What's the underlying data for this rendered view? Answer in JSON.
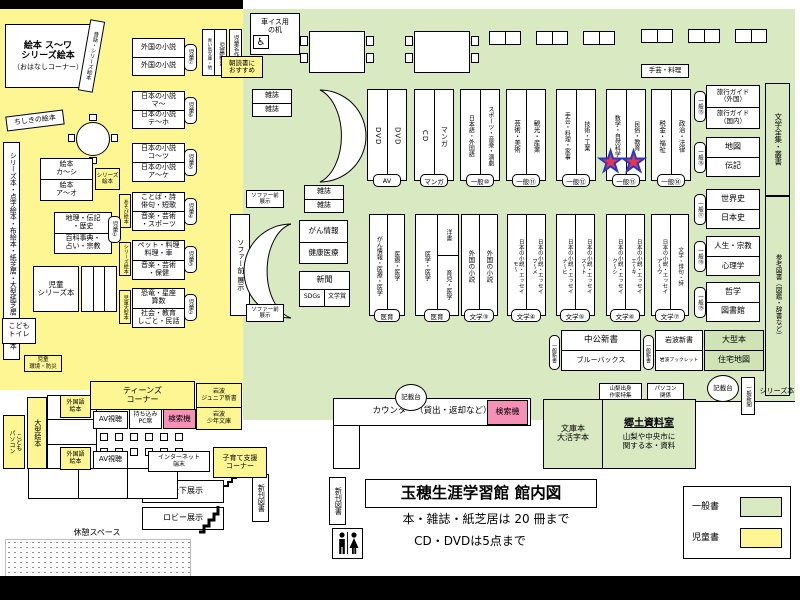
{
  "colors": {
    "general_zone": "#d9eac3",
    "children_zone": "#fdf693",
    "search_machine_pink": "#f590b6",
    "star_fill": "#e8344e",
    "star_border": "#2439c8"
  },
  "title_block": {
    "title": "玉穂生涯学習館 館内図",
    "rule1": "本・雑誌・紙芝居は 20 冊まで",
    "rule2": "CD・DVDは5点まで"
  },
  "legend": {
    "general": "一般書",
    "children": "児童書"
  },
  "kids": {
    "ohanashi1": "絵本 ス～ワ",
    "ohanashi2": "シリーズ絵本",
    "ohanashi3": "（おはなしコーナー）",
    "mukashi_shelf": "昔話・シリーズ絵本",
    "chishiki": "ちしきの絵本",
    "left_strip": "シリーズ本・点字絵本・布絵本・紙芝居・大型紙芝居・大型絵本",
    "shelf7": {
      "top": "外国の小説",
      "bottom": "外国の小説",
      "tag": "児童⑦"
    },
    "shelf6": {
      "top": "日本の小説\nマ～",
      "bottom": "日本の小説\nテ～ホ",
      "tag": "児童⑥"
    },
    "shelf5": {
      "top": "日本の小説\nコ～ツ",
      "bottom": "日本の小説\nア～ケ",
      "tag": "児童⑤"
    },
    "shelf4": {
      "top": "ことば・詩\n俳句・短歌",
      "bottom": "音楽・芸術\n・スポーツ",
      "tag": "児童④",
      "side": "あそび絵本"
    },
    "shelf3": {
      "top": "ペット・料理\n料理・車",
      "bottom": "音楽・芸術\n・保健",
      "tag": "児童③",
      "side": "シリーズ絵本"
    },
    "shelf2": {
      "top": "恐竜・星座\n算数",
      "bottom": "社会・教育\nしごと・民話",
      "tag": "児童②",
      "side": "児童大型本"
    },
    "ehon_ka": {
      "top": "絵本\nカ～シ",
      "bottom": "絵本\nア～オ",
      "side": "シリーズ\n絵本"
    },
    "shelf1": {
      "top": "地理・伝記\n・歴史",
      "bottom": "百科事典・\n占い・宗教",
      "tag": "児童①"
    },
    "jido_series": "児童\nシリーズ本",
    "kodomo_toilet": "こども\nトイレ",
    "jido_kankyo": "児童\n環境・防災",
    "ogata_ehon": "大型絵本",
    "kodomo_pc": "こども\nパソコン",
    "jido_shinsho": "児童新書",
    "aoitori": "青い鳥文庫・他",
    "jido_meisaku": "児童名作",
    "asadoku": "朝読書に\nおすすめ"
  },
  "teens": {
    "corner": "ティーンズ\nコーナー",
    "av": "AV視聴",
    "pc_seat": "持ち込み\nPC席",
    "search": "検索機",
    "gaikokugo_ehon": "外国語\n絵本",
    "iwanami_jr": "岩波\nジュニア新書",
    "iwanami_shonen": "岩波\n少年文庫",
    "internet": "インターネット\n端末",
    "kosodate": "子育て支援\nコーナー"
  },
  "general": {
    "wheelchair_desk": "車イス用\nの机",
    "magazine": "雑誌",
    "sofa_front_v": "ソファー前 展示",
    "sofa_front": "ソファー前\n展示",
    "cancer_box": {
      "top": "がん情報",
      "bottom": "健康医療"
    },
    "news_box": {
      "top": "新聞",
      "left": "SDGs",
      "right": "文学賞"
    },
    "craft_note": "手芸・料理",
    "row1": [
      {
        "left": "DVD",
        "right": "DVD",
        "tag": "AV"
      },
      {
        "left": "CD",
        "right": "マンガ",
        "tag": "マンガ"
      },
      {
        "left": "日本語・外国語",
        "right": "スポーツ・音楽・演劇",
        "tag": "一般⑩"
      },
      {
        "left": "芸術・美術",
        "right": "観光・産業",
        "tag": "一般⑪"
      },
      {
        "left": "手芸・料理・家事",
        "right": "技術・工業",
        "tag": "一般⑫"
      },
      {
        "left": "数学・自然科学",
        "right": "民俗・教育",
        "tag": "一般⑬"
      },
      {
        "left": "税金・福祉",
        "right": "政治・法律",
        "tag": "一般⑭"
      }
    ],
    "row2": [
      {
        "left": "がん情報・医療・医学",
        "right": "医療・医学",
        "tag": "医育"
      },
      {
        "left": "医学・医学",
        "right_top": "洋書",
        "right_bottom": "育児・医学",
        "tag": "医育"
      },
      {
        "left": "外国の小説",
        "right": "外国の小説",
        "tag": "文学③"
      },
      {
        "left": "日本の小説・エッセイ\nモ～",
        "right": "日本の小説・エッセイ\nフ～メ",
        "tag": "文学④"
      },
      {
        "left": "日本の小説・エッセイ\nナ～ヒ",
        "right": "日本の小説・エッセイ\nス～ト",
        "tag": "文学⑤"
      },
      {
        "left": "日本の小説・エッセイ\nク～シ",
        "right": "日本の小説・エッセイ\nエ～キ",
        "tag": "文学⑥"
      },
      {
        "left": "日本の小説・エッセイ\nア～ウ",
        "right": "文学・俳句・詩",
        "tag": "文学⑦"
      }
    ],
    "right_col": [
      {
        "top": "旅行ガイド\n（外国）",
        "bottom": "旅行ガイド\n（国内）",
        "tag": "一般⑮"
      },
      {
        "top": "地図",
        "bottom": "伝記",
        "tag": "一般⑯"
      },
      {
        "top": "世界史",
        "bottom": "日本史",
        "tag": "一般⑰"
      },
      {
        "top": "人生・宗教",
        "bottom": "心理学",
        "tag": "一般⑱"
      },
      {
        "top": "哲学",
        "bottom": "図書館",
        "tag": "一般⑲"
      },
      {
        "top": "大型本",
        "bottom": "住宅地図",
        "tag": ""
      }
    ],
    "bungaku_zenshu": "文学全集・叢書",
    "sanko_tosho": "参考図書（図鑑・辞書など）",
    "shinsho": [
      {
        "top": "中公新書",
        "bottom": "ブルーバックス",
        "tag": "一般新書"
      },
      {
        "top": "岩波新書",
        "bottom": "岩波ブックレット",
        "tag": "一般新書"
      }
    ],
    "yamanashi_feature": "山梨出身\n作家特集",
    "pc_related": "パソコン\n関係",
    "kisaidai": "記載台",
    "ippan_shinbun": "一般新聞",
    "series_bon": "シリーズ本",
    "counter_label": "カウンター（貸出・返却など）",
    "search_machine": "検索機",
    "bunkobon": "文庫本\n大活字本",
    "kyodo": {
      "title": "郷土資料室",
      "desc": "山梨や中央市に\n関する本・資料"
    }
  },
  "facilities": {
    "shinkan_tosho": "新刊図書",
    "kaidan_exhibit": "階段下展示",
    "lobby_exhibit": "ロビー展示",
    "rest_space": "休憩スペース"
  }
}
